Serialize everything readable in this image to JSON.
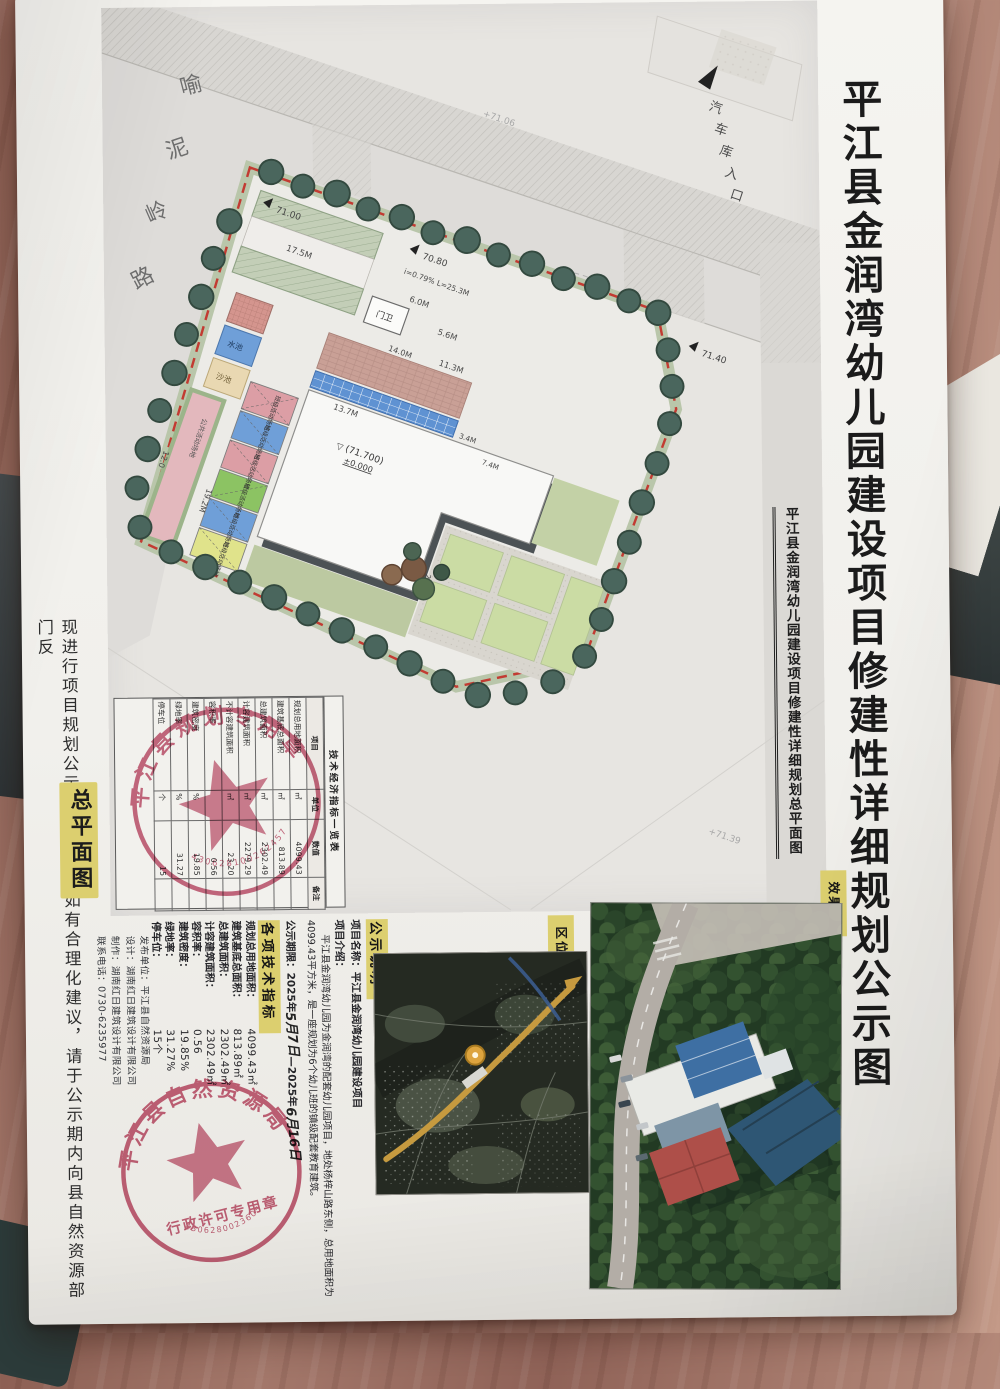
{
  "colors": {
    "highlight_yellow": "#dccf6f",
    "stamp_red": "#c05570",
    "boundary_red": "#c23b32",
    "paper": "#f2f1ec"
  },
  "poster": {
    "main_title": "平江县金润湾幼儿园建设项目修建性详细规划公示图",
    "side_note": "现进行项目规划公示，各界人士如有合理化建议，请于公示期内向县自然资源部门反",
    "siteplan_label": "总平面图",
    "publisher_lines": [
      "发布单位：平江县自然资源局",
      "设计：湖南红日建筑设计有限公司",
      "制作：湖南红日建筑设计有限公司",
      "联系电话：0730-6235977"
    ]
  },
  "site_plan": {
    "subtitle": "平江县金润湾幼儿园建设项目修建性详细规划总平面图",
    "roads": {
      "yangzishan": "杨梓山路",
      "yuniling_chars": [
        "喻",
        "泥",
        "岭",
        "路"
      ],
      "garage_chars": [
        "汽",
        "车",
        "库",
        "入",
        "口"
      ]
    },
    "labels": {
      "gatehouse": "门卫",
      "public_activity": "公共活动场地",
      "class_activity": "班级活动场地",
      "pool": "水池",
      "sandpit": "沙池",
      "elev": "(71.700)",
      "zero": "±0.000",
      "slope": "i=0.79% L=25.3M"
    },
    "dims": {
      "d175": "17.5M",
      "d60": "6.0M",
      "d56": "5.6M",
      "d113": "11.3M",
      "d137": "13.7M",
      "d96": "9.6M",
      "d192": "19.2M",
      "d120": "12.0",
      "d247": "24.7M",
      "d140": "14.0M",
      "d34": "3.4M",
      "d74": "7.4M"
    },
    "elevations": {
      "e1": "71.00",
      "e2": "70.80",
      "e3": "71.40",
      "e4": "+71.06",
      "e5": "+71.39"
    },
    "table": {
      "title": "技术经济指标一览表",
      "headers": [
        "项目",
        "单位",
        "数值",
        "备注"
      ],
      "rows": [
        [
          "规划总用地面积",
          "㎡",
          "4099.43",
          ""
        ],
        [
          "建筑基底总面积",
          "㎡",
          "813.89",
          ""
        ],
        [
          "总建筑面积",
          "㎡",
          "2302.49",
          ""
        ],
        [
          "计容建筑面积",
          "㎡",
          "2279.29",
          ""
        ],
        [
          "不计容建筑面积",
          "㎡",
          "23.20",
          ""
        ],
        [
          "容积率",
          "",
          "0.56",
          ""
        ],
        [
          "建筑密度",
          "%",
          "19.85",
          ""
        ],
        [
          "绿地率",
          "%",
          "31.27",
          ""
        ],
        [
          "停车位",
          "个",
          "15",
          ""
        ]
      ]
    },
    "stamp": {
      "arc": "平江县规划专用章",
      "number": "430628100262457"
    }
  },
  "notice": {
    "heading": "公示说明",
    "name_label": "项目名称：",
    "name_value": "平江县金润湾幼儿园建设项目",
    "intro_label": "项目介绍：",
    "intro_text": "平江县金润湾幼儿园为金润湾的配套幼儿园项目，地处杨梓山路东侧，总用地面积为4099.43平方米，是一座规划为6个幼儿班的镇级配套教育建筑。",
    "period_label": "公示期限：",
    "period_prefix": "2025年",
    "period_hand1": "5月7日",
    "period_mid": "—2025年",
    "period_hand2": "6月16日",
    "tech_heading": "各项技术指标",
    "indicators": [
      {
        "label": "规划总用地面积：",
        "value": "4099.43㎡"
      },
      {
        "label": "建筑基底总面积：",
        "value": "813.89㎡"
      },
      {
        "label": "总建筑面积：",
        "value": "2302.49㎡"
      },
      {
        "label": "计容建筑面积：",
        "value": "2302.49㎡"
      },
      {
        "label": "容积率：",
        "value": "0.56"
      },
      {
        "label": "建筑密度：",
        "value": "19.85%"
      },
      {
        "label": "绿地率：",
        "value": "31.27%"
      },
      {
        "label": "停车位：",
        "value": "15个"
      }
    ],
    "stamp": {
      "arc": "平江县自然资源局",
      "banner": "行政许可专用章",
      "number": "4306280023605"
    }
  },
  "location_map": {
    "label": "区位图"
  },
  "rendering": {
    "label": "效果图"
  }
}
